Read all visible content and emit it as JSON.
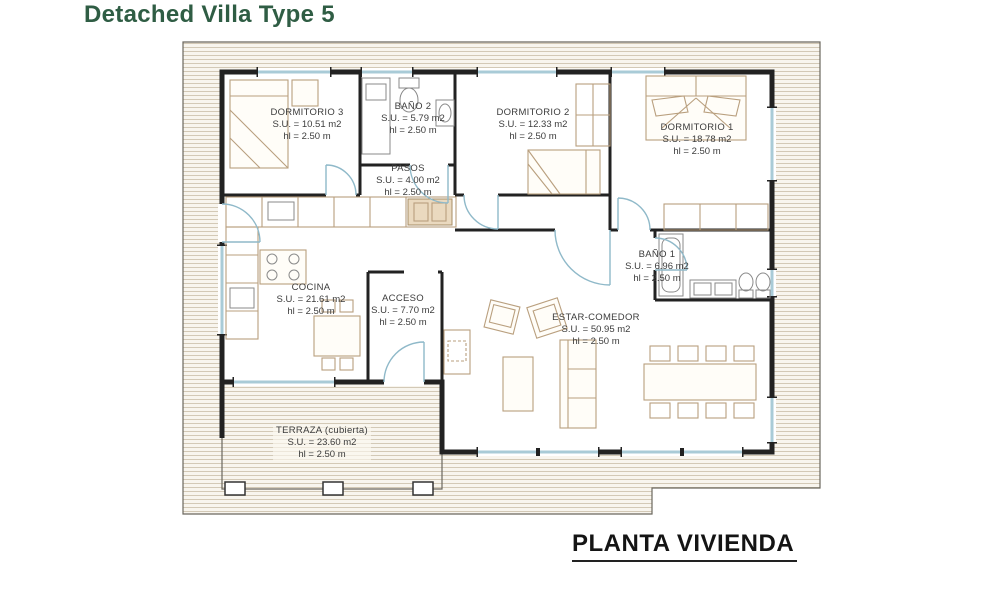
{
  "title": "Detached Villa Type 5",
  "caption": "PLANTA VIVIENDA",
  "rooms": [
    {
      "name": "DORMITORIO 3",
      "area": "S.U. = 10.51 m2",
      "height": "hl = 2.50 m"
    },
    {
      "name": "BAÑO 2",
      "area": "S.U. = 5.79 m2",
      "height": "hl = 2.50 m"
    },
    {
      "name": "DORMITORIO 2",
      "area": "S.U. = 12.33 m2",
      "height": "hl = 2.50 m"
    },
    {
      "name": "DORMITORIO 1",
      "area": "S.U. = 18.78 m2",
      "height": "hl = 2.50 m"
    },
    {
      "name": "PASOS",
      "area": "S.U. = 4.00 m2",
      "height": "hl = 2.50 m"
    },
    {
      "name": "BAÑO 1",
      "area": "S.U. = 6.96 m2",
      "height": "hl = 2.50 m"
    },
    {
      "name": "COCINA",
      "area": "S.U. = 21.61 m2",
      "height": "hl = 2.50 m"
    },
    {
      "name": "ACCESO",
      "area": "S.U. = 7.70 m2",
      "height": "hl = 2.50 m"
    },
    {
      "name": "ESTAR-COMEDOR",
      "area": "S.U. = 50.95 m2",
      "height": "hl = 2.50 m"
    },
    {
      "name": "TERRAZA (cubierta)",
      "area": "S.U. = 23.60 m2",
      "height": "hl = 2.50 m"
    }
  ],
  "colors": {
    "title_green": "#2F5D44",
    "caption_black": "#141414",
    "wall": "#222222",
    "glazing_blue": "#A9CBD7",
    "door_arc_blue": "#8FB9C9",
    "furniture_tan": "#B99F7E",
    "hatch_line": "#D3C9B6",
    "hatch_bg": "#F8F5EE",
    "label_text": "#3C3C3C"
  }
}
